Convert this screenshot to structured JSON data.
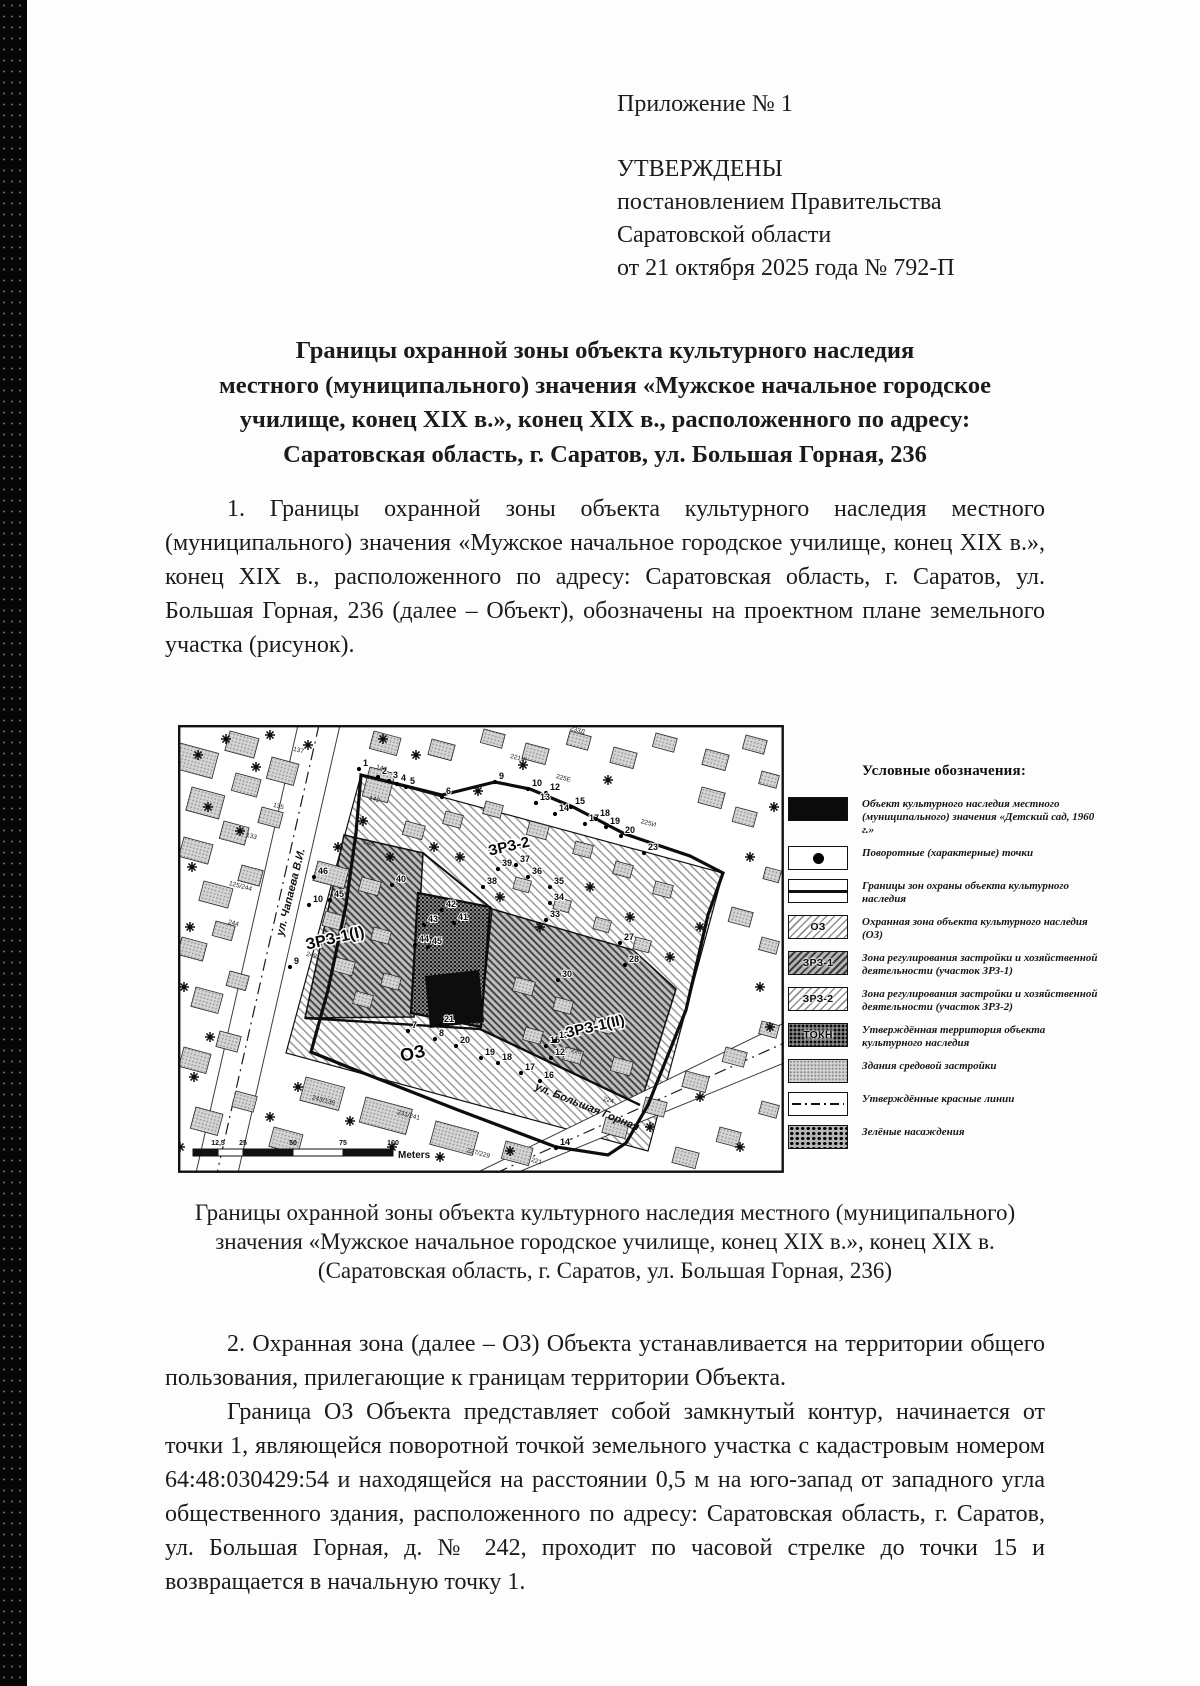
{
  "header": {
    "annex": "Приложение № 1",
    "approved": "УТВЕРЖДЕНЫ",
    "lines": [
      "постановлением Правительства",
      "Саратовской области",
      "от 21 октября 2025 года № 792-П"
    ]
  },
  "title": {
    "lines": [
      "Границы охранной зоны объекта культурного наследия",
      "местного (муниципального) значения «Мужское начальное городское",
      "училище, конец XIX в.», конец XIX в., расположенного по адресу:",
      "Саратовская область, г. Саратов, ул. Большая Горная, 236"
    ]
  },
  "body": {
    "paragraph1": "1. Границы охранной зоны объекта культурного наследия местного (муниципального) значения «Мужское начальное городское училище, конец XIX в.», конец XIX в., расположенного по адресу: Саратовская область, г. Саратов, ул. Большая Горная, 236 (далее – Объект), обозначены на проектном плане земельного участка (рисунок).",
    "paragraph2": "2. Охранная зона (далее – ОЗ) Объекта устанавливается на территории общего пользования, прилегающие к границам территории Объекта.",
    "paragraph3": "Граница ОЗ Объекта представляет собой замкнутый контур, начинается от точки 1, являющейся поворотной точкой земельного участка с кадастровым номером 64:48:030429:54 и находящейся на расстоянии 0,5 м на юго-запад от западного угла общественного здания, расположенного по адресу: Саратовская область, г. Саратов, ул. Большая Горная, д. № 242, проходит по часовой стрелке до точки 15 и возвращается в начальную точку 1."
  },
  "figure": {
    "caption_lines": [
      "Границы охранной зоны объекта культурного наследия местного (муниципального)",
      "значения «Мужское начальное городское училище, конец XIX в.», конец XIX в.",
      "(Саратовская область, г. Саратов, ул. Большая Горная, 236)"
    ],
    "legend": {
      "title": "Условные обозначения:",
      "items": [
        {
          "swatch": "sw-object",
          "text": "",
          "label": "Объект культурного наследия местного (муниципального) значения «Детский сад, 1960 г.»"
        },
        {
          "swatch": "sw-point",
          "text": "",
          "label": "Поворотные (характерные) точки"
        },
        {
          "swatch": "sw-line",
          "text": "",
          "label": "Границы зон охраны объекта культурного наследия"
        },
        {
          "swatch": "sw-hatch",
          "text": "ОЗ",
          "label": "Охранная зона объекта культурного наследия (ОЗ)"
        },
        {
          "swatch": "sw-hatch-dark",
          "text": "ЗРЗ-1",
          "label": "Зона регулирования застройки и хозяйственной деятельности (участок ЗРЗ-1)"
        },
        {
          "swatch": "sw-hatch",
          "text": "ЗРЗ-2",
          "label": "Зона регулирования застройки и хозяйственной деятельности (участок ЗРЗ-2)"
        },
        {
          "swatch": "sw-tokn",
          "text": "ТОКН",
          "label": "Утверждённая территория объекта культурного наследия"
        },
        {
          "swatch": "sw-bld",
          "text": "",
          "label": "Здания средовой застройки"
        },
        {
          "swatch": "sw-red",
          "text": "",
          "label": "Утверждённые красные линии"
        },
        {
          "swatch": "sw-green",
          "text": "",
          "label": "Зелёные насаждения"
        }
      ]
    },
    "map": {
      "zone_labels": [
        [
          "ЗРЗ-1(I)",
          158,
          218,
          -13,
          16
        ],
        [
          "ЗРЗ-2",
          332,
          126,
          -13,
          15
        ],
        [
          "ЗРЗ-1(II)",
          418,
          306,
          -13,
          15
        ],
        [
          "ОЗ",
          236,
          334,
          -13,
          18
        ]
      ],
      "street_labels": [
        [
          "ул. Чапаева В.И.",
          116,
          168,
          -76
        ],
        [
          "ул. Большая Горная",
          408,
          385,
          22
        ]
      ],
      "house_numbers": [
        [
          "133",
          73,
          113,
          15
        ],
        [
          "135",
          100,
          83,
          15
        ],
        [
          "137",
          120,
          27,
          15
        ],
        [
          "144",
          203,
          45,
          15
        ],
        [
          "142",
          196,
          76,
          15
        ],
        [
          "140",
          190,
          120,
          15
        ],
        [
          "125/244",
          62,
          163,
          15
        ],
        [
          "244",
          55,
          200,
          15
        ],
        [
          "242",
          133,
          232,
          15
        ],
        [
          "243/136",
          145,
          377,
          15
        ],
        [
          "231/241",
          230,
          392,
          15
        ],
        [
          "227/229",
          300,
          430,
          15
        ],
        [
          "221",
          358,
          438,
          15
        ],
        [
          "226",
          398,
          328,
          15
        ],
        [
          "224",
          430,
          377,
          15
        ],
        [
          "233Д",
          399,
          7,
          15
        ],
        [
          "221Ж",
          340,
          35,
          15
        ],
        [
          "225Е",
          385,
          55,
          15
        ],
        [
          "225И",
          470,
          100,
          15
        ]
      ],
      "points": [
        [
          "1",
          181,
          44
        ],
        [
          "2",
          200,
          52
        ],
        [
          "3",
          211,
          56
        ],
        [
          "4",
          219,
          59
        ],
        [
          "5",
          228,
          62
        ],
        [
          "6",
          264,
          72
        ],
        [
          "9",
          317,
          57
        ],
        [
          "10",
          350,
          64
        ],
        [
          "12",
          368,
          68
        ],
        [
          "13",
          358,
          78
        ],
        [
          "14",
          377,
          89
        ],
        [
          "15",
          393,
          82
        ],
        [
          "17",
          407,
          99
        ],
        [
          "18",
          418,
          94
        ],
        [
          "19",
          428,
          102
        ],
        [
          "20",
          443,
          111
        ],
        [
          "23",
          466,
          128
        ],
        [
          "27",
          442,
          218
        ],
        [
          "28",
          447,
          240
        ],
        [
          "30",
          380,
          255
        ],
        [
          "33",
          368,
          195
        ],
        [
          "34",
          372,
          178
        ],
        [
          "35",
          372,
          162
        ],
        [
          "36",
          350,
          152
        ],
        [
          "37",
          338,
          140
        ],
        [
          "38",
          305,
          162
        ],
        [
          "39",
          320,
          144
        ],
        [
          "40",
          214,
          160
        ],
        [
          "42",
          264,
          185
        ],
        [
          "41",
          276,
          198
        ],
        [
          "43",
          246,
          200
        ],
        [
          "44",
          237,
          220
        ],
        [
          "45",
          250,
          222
        ],
        [
          "46",
          136,
          152
        ],
        [
          "10",
          131,
          180
        ],
        [
          "45",
          152,
          175
        ],
        [
          "9",
          112,
          242
        ],
        [
          "21",
          262,
          300
        ],
        [
          "7",
          230,
          306
        ],
        [
          "8",
          257,
          314
        ],
        [
          "20",
          278,
          321
        ],
        [
          "19",
          303,
          333
        ],
        [
          "18",
          320,
          338
        ],
        [
          "17",
          343,
          348
        ],
        [
          "16",
          362,
          356
        ],
        [
          "15",
          368,
          321
        ],
        [
          "13",
          377,
          316
        ],
        [
          "12",
          373,
          333
        ],
        [
          "14",
          378,
          423
        ]
      ],
      "trees": [
        [
          20,
          30
        ],
        [
          48,
          14
        ],
        [
          78,
          42
        ],
        [
          30,
          82
        ],
        [
          62,
          106
        ],
        [
          14,
          142
        ],
        [
          92,
          10
        ],
        [
          130,
          20
        ],
        [
          205,
          14
        ],
        [
          238,
          30
        ],
        [
          185,
          96
        ],
        [
          160,
          122
        ],
        [
          212,
          132
        ],
        [
          256,
          122
        ],
        [
          282,
          132
        ],
        [
          322,
          172
        ],
        [
          362,
          202
        ],
        [
          412,
          162
        ],
        [
          452,
          192
        ],
        [
          492,
          232
        ],
        [
          522,
          202
        ],
        [
          120,
          362
        ],
        [
          92,
          392
        ],
        [
          172,
          396
        ],
        [
          214,
          422
        ],
        [
          262,
          432
        ],
        [
          332,
          426
        ],
        [
          472,
          402
        ],
        [
          522,
          372
        ],
        [
          562,
          422
        ],
        [
          592,
          302
        ],
        [
          582,
          262
        ],
        [
          12,
          202
        ],
        [
          6,
          262
        ],
        [
          32,
          312
        ],
        [
          16,
          352
        ],
        [
          2,
          422
        ],
        [
          596,
          82
        ],
        [
          572,
          132
        ],
        [
          300,
          66
        ],
        [
          345,
          40
        ],
        [
          430,
          55
        ]
      ],
      "buildings": [
        [
          2,
          18,
          40,
          26,
          15
        ],
        [
          52,
          6,
          30,
          20,
          15
        ],
        [
          14,
          62,
          34,
          24,
          15
        ],
        [
          58,
          48,
          26,
          18,
          15
        ],
        [
          94,
          32,
          28,
          22,
          15
        ],
        [
          6,
          112,
          30,
          20,
          15
        ],
        [
          46,
          96,
          26,
          18,
          15
        ],
        [
          84,
          82,
          22,
          16,
          15
        ],
        [
          26,
          156,
          30,
          20,
          15
        ],
        [
          64,
          140,
          22,
          16,
          15
        ],
        [
          4,
          212,
          26,
          18,
          15
        ],
        [
          38,
          196,
          20,
          15,
          15
        ],
        [
          18,
          262,
          28,
          20,
          15
        ],
        [
          52,
          246,
          20,
          15,
          15
        ],
        [
          6,
          322,
          28,
          20,
          15
        ],
        [
          42,
          306,
          22,
          16,
          15
        ],
        [
          18,
          382,
          28,
          22,
          15
        ],
        [
          58,
          366,
          22,
          16,
          15
        ],
        [
          96,
          402,
          30,
          20,
          15
        ],
        [
          196,
          6,
          28,
          18,
          15
        ],
        [
          254,
          14,
          24,
          16,
          15
        ],
        [
          306,
          4,
          22,
          14,
          15
        ],
        [
          348,
          18,
          24,
          16,
          15
        ],
        [
          392,
          6,
          22,
          14,
          15
        ],
        [
          436,
          22,
          24,
          16,
          15
        ],
        [
          478,
          8,
          22,
          14,
          15
        ],
        [
          528,
          24,
          24,
          16,
          15
        ],
        [
          568,
          10,
          22,
          14,
          15
        ],
        [
          192,
          42,
          26,
          30,
          15
        ],
        [
          228,
          96,
          20,
          14,
          15
        ],
        [
          268,
          86,
          18,
          13,
          15
        ],
        [
          308,
          76,
          18,
          13,
          15
        ],
        [
          352,
          96,
          20,
          14,
          15
        ],
        [
          398,
          116,
          18,
          13,
          15
        ],
        [
          438,
          136,
          18,
          13,
          15
        ],
        [
          478,
          156,
          18,
          13,
          15
        ],
        [
          338,
          152,
          16,
          12,
          15
        ],
        [
          378,
          172,
          16,
          12,
          15
        ],
        [
          418,
          192,
          16,
          12,
          15
        ],
        [
          458,
          212,
          16,
          12,
          15
        ],
        [
          140,
          136,
          32,
          20,
          15
        ],
        [
          184,
          152,
          20,
          14,
          15
        ],
        [
          148,
          186,
          22,
          15,
          15
        ],
        [
          196,
          202,
          18,
          13,
          15
        ],
        [
          158,
          232,
          20,
          14,
          15
        ],
        [
          206,
          248,
          18,
          13,
          15
        ],
        [
          178,
          266,
          18,
          13,
          15
        ],
        [
          338,
          252,
          20,
          14,
          15
        ],
        [
          378,
          272,
          18,
          13,
          15
        ],
        [
          418,
          292,
          18,
          13,
          15
        ],
        [
          348,
          302,
          18,
          13,
          15
        ],
        [
          388,
          322,
          18,
          13,
          15
        ],
        [
          436,
          332,
          20,
          14,
          15
        ],
        [
          128,
          352,
          40,
          24,
          15
        ],
        [
          188,
          372,
          48,
          26,
          15
        ],
        [
          258,
          396,
          44,
          24,
          15
        ],
        [
          328,
          416,
          28,
          18,
          15
        ],
        [
          428,
          392,
          24,
          16,
          15
        ],
        [
          468,
          372,
          22,
          15,
          15
        ],
        [
          508,
          346,
          24,
          16,
          15
        ],
        [
          548,
          322,
          22,
          15,
          15
        ],
        [
          584,
          296,
          18,
          13,
          15
        ],
        [
          498,
          422,
          24,
          16,
          15
        ],
        [
          542,
          402,
          22,
          15,
          15
        ],
        [
          584,
          376,
          18,
          13,
          15
        ],
        [
          524,
          62,
          24,
          16,
          15
        ],
        [
          558,
          82,
          22,
          15,
          15
        ],
        [
          584,
          46,
          18,
          13,
          15
        ],
        [
          554,
          182,
          22,
          15,
          15
        ],
        [
          584,
          212,
          18,
          13,
          15
        ],
        [
          588,
          142,
          16,
          12,
          15
        ]
      ],
      "scale": {
        "ticks": [
          "12,5",
          "25",
          "50",
          "75",
          "100"
        ],
        "unit": "Meters"
      }
    }
  }
}
